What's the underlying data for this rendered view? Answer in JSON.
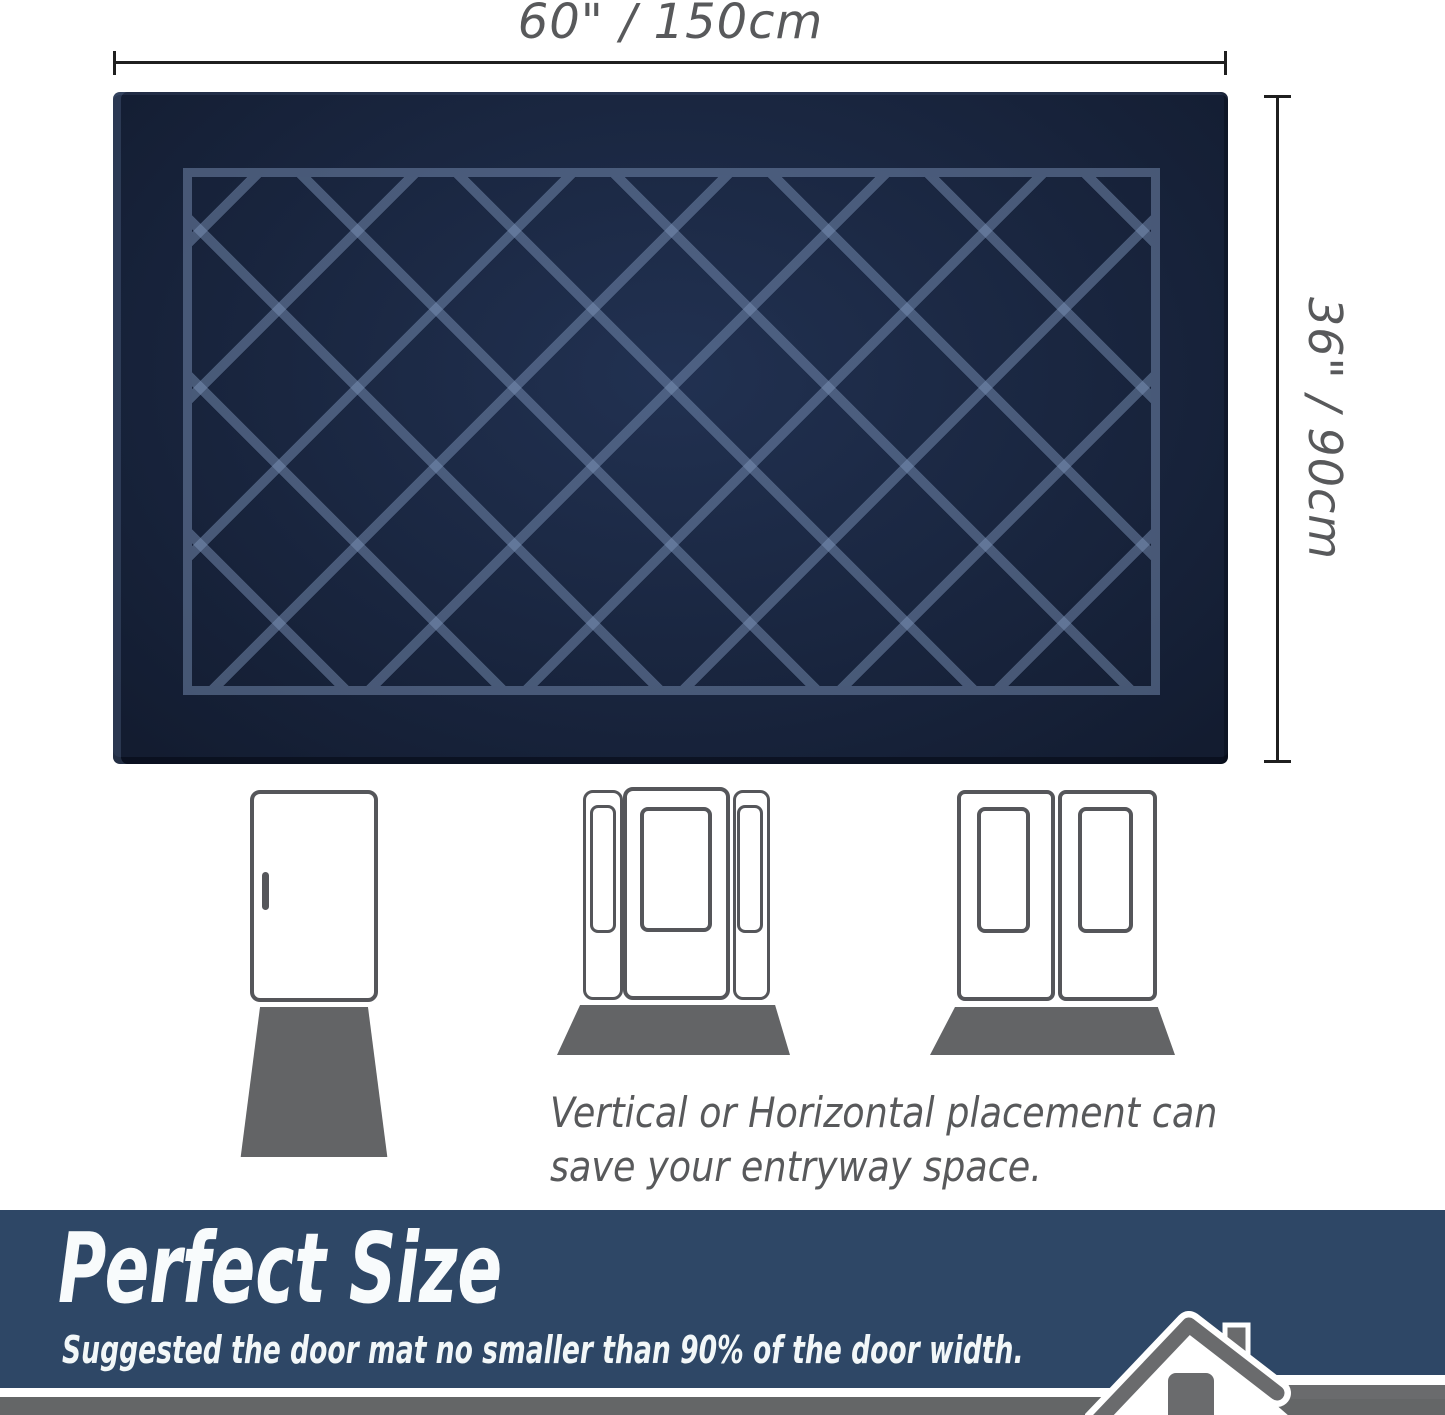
{
  "dimensions": {
    "width_label": "60\" / 150cm",
    "height_label": "36\" / 90cm"
  },
  "mat": {
    "pattern": "diamond-lattice",
    "color_base": "#1a2743",
    "color_pattern": "#7d92b3"
  },
  "doors": [
    {
      "type": "single-door",
      "mat_placement": "vertical"
    },
    {
      "type": "door-with-sidelights",
      "mat_placement": "horizontal"
    },
    {
      "type": "double-door",
      "mat_placement": "horizontal"
    }
  ],
  "caption": {
    "line1": "Vertical or Horizontal placement can",
    "line2": "save your entryway space."
  },
  "banner": {
    "title": "Perfect Size",
    "subtitle": "Suggested the door mat no smaller than 90% of the door width.",
    "background": "#2e4766",
    "text_color": "#ffffff"
  },
  "colors": {
    "dimension_line": "#1f1f1f",
    "label_gray": "#58595b",
    "door_outline": "#55565a",
    "floor_mat_gray": "#636466",
    "footer_strip_gray": "#646667",
    "house_icon_gray": "#6a6b6d"
  }
}
